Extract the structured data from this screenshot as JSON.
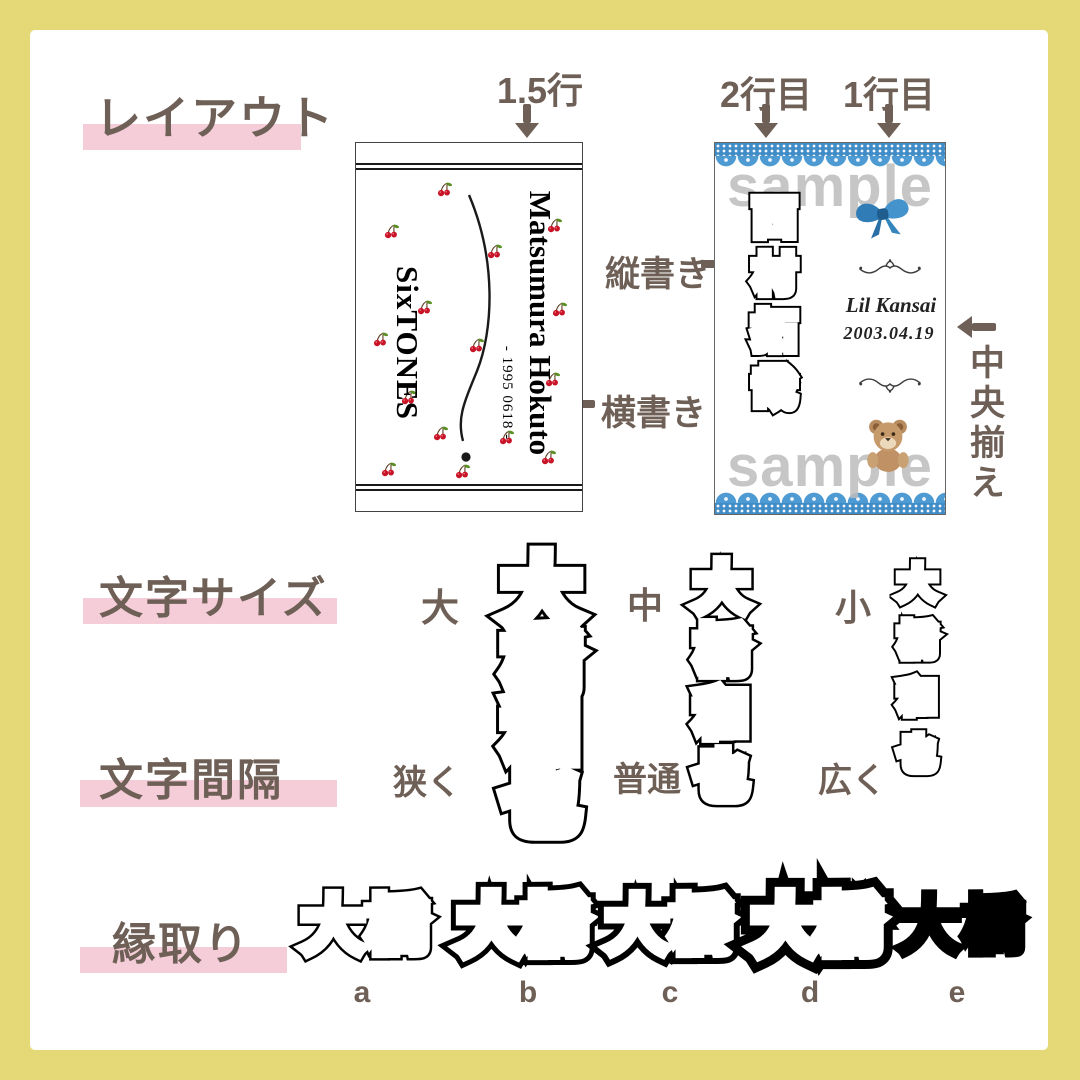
{
  "colors": {
    "frame_yellow": "#e5d977",
    "heading_brown": "#6f6057",
    "highlight_pink": "#f4cdd8",
    "lace_blue": "#4e9ad2",
    "ribbon_blue": "#2f7cb6",
    "watermark_gray": "#bdbdbd",
    "cherry_red": "#c81426"
  },
  "headings": {
    "layout": "レイアウト",
    "size": "文字サイズ",
    "spacing": "文字間隔",
    "outline": "縁取り"
  },
  "annotations": {
    "line_1_5": "1.5行",
    "line_2": "2行目",
    "line_1": "1行目",
    "vertical_writing": "縦書き",
    "horizontal_writing": "横書き",
    "center_align": "中央揃え"
  },
  "card_left": {
    "group": "SixTONES",
    "name": "Matsumura Hokuto",
    "birth": "- 1995 0618 -"
  },
  "card_right": {
    "name": "西村拓哉",
    "group": "Lil Kansai",
    "birth": "2003.04.19",
    "watermark": "sample"
  },
  "size_section": {
    "sample": "大橋和也",
    "labels": {
      "large": "大",
      "medium": "中",
      "small": "小"
    }
  },
  "spacing_section": {
    "labels": {
      "narrow": "狭く",
      "normal": "普通",
      "wide": "広く"
    }
  },
  "outline_section": {
    "sample": "大橋",
    "variant_labels": [
      "a",
      "b",
      "c",
      "d",
      "e"
    ]
  }
}
